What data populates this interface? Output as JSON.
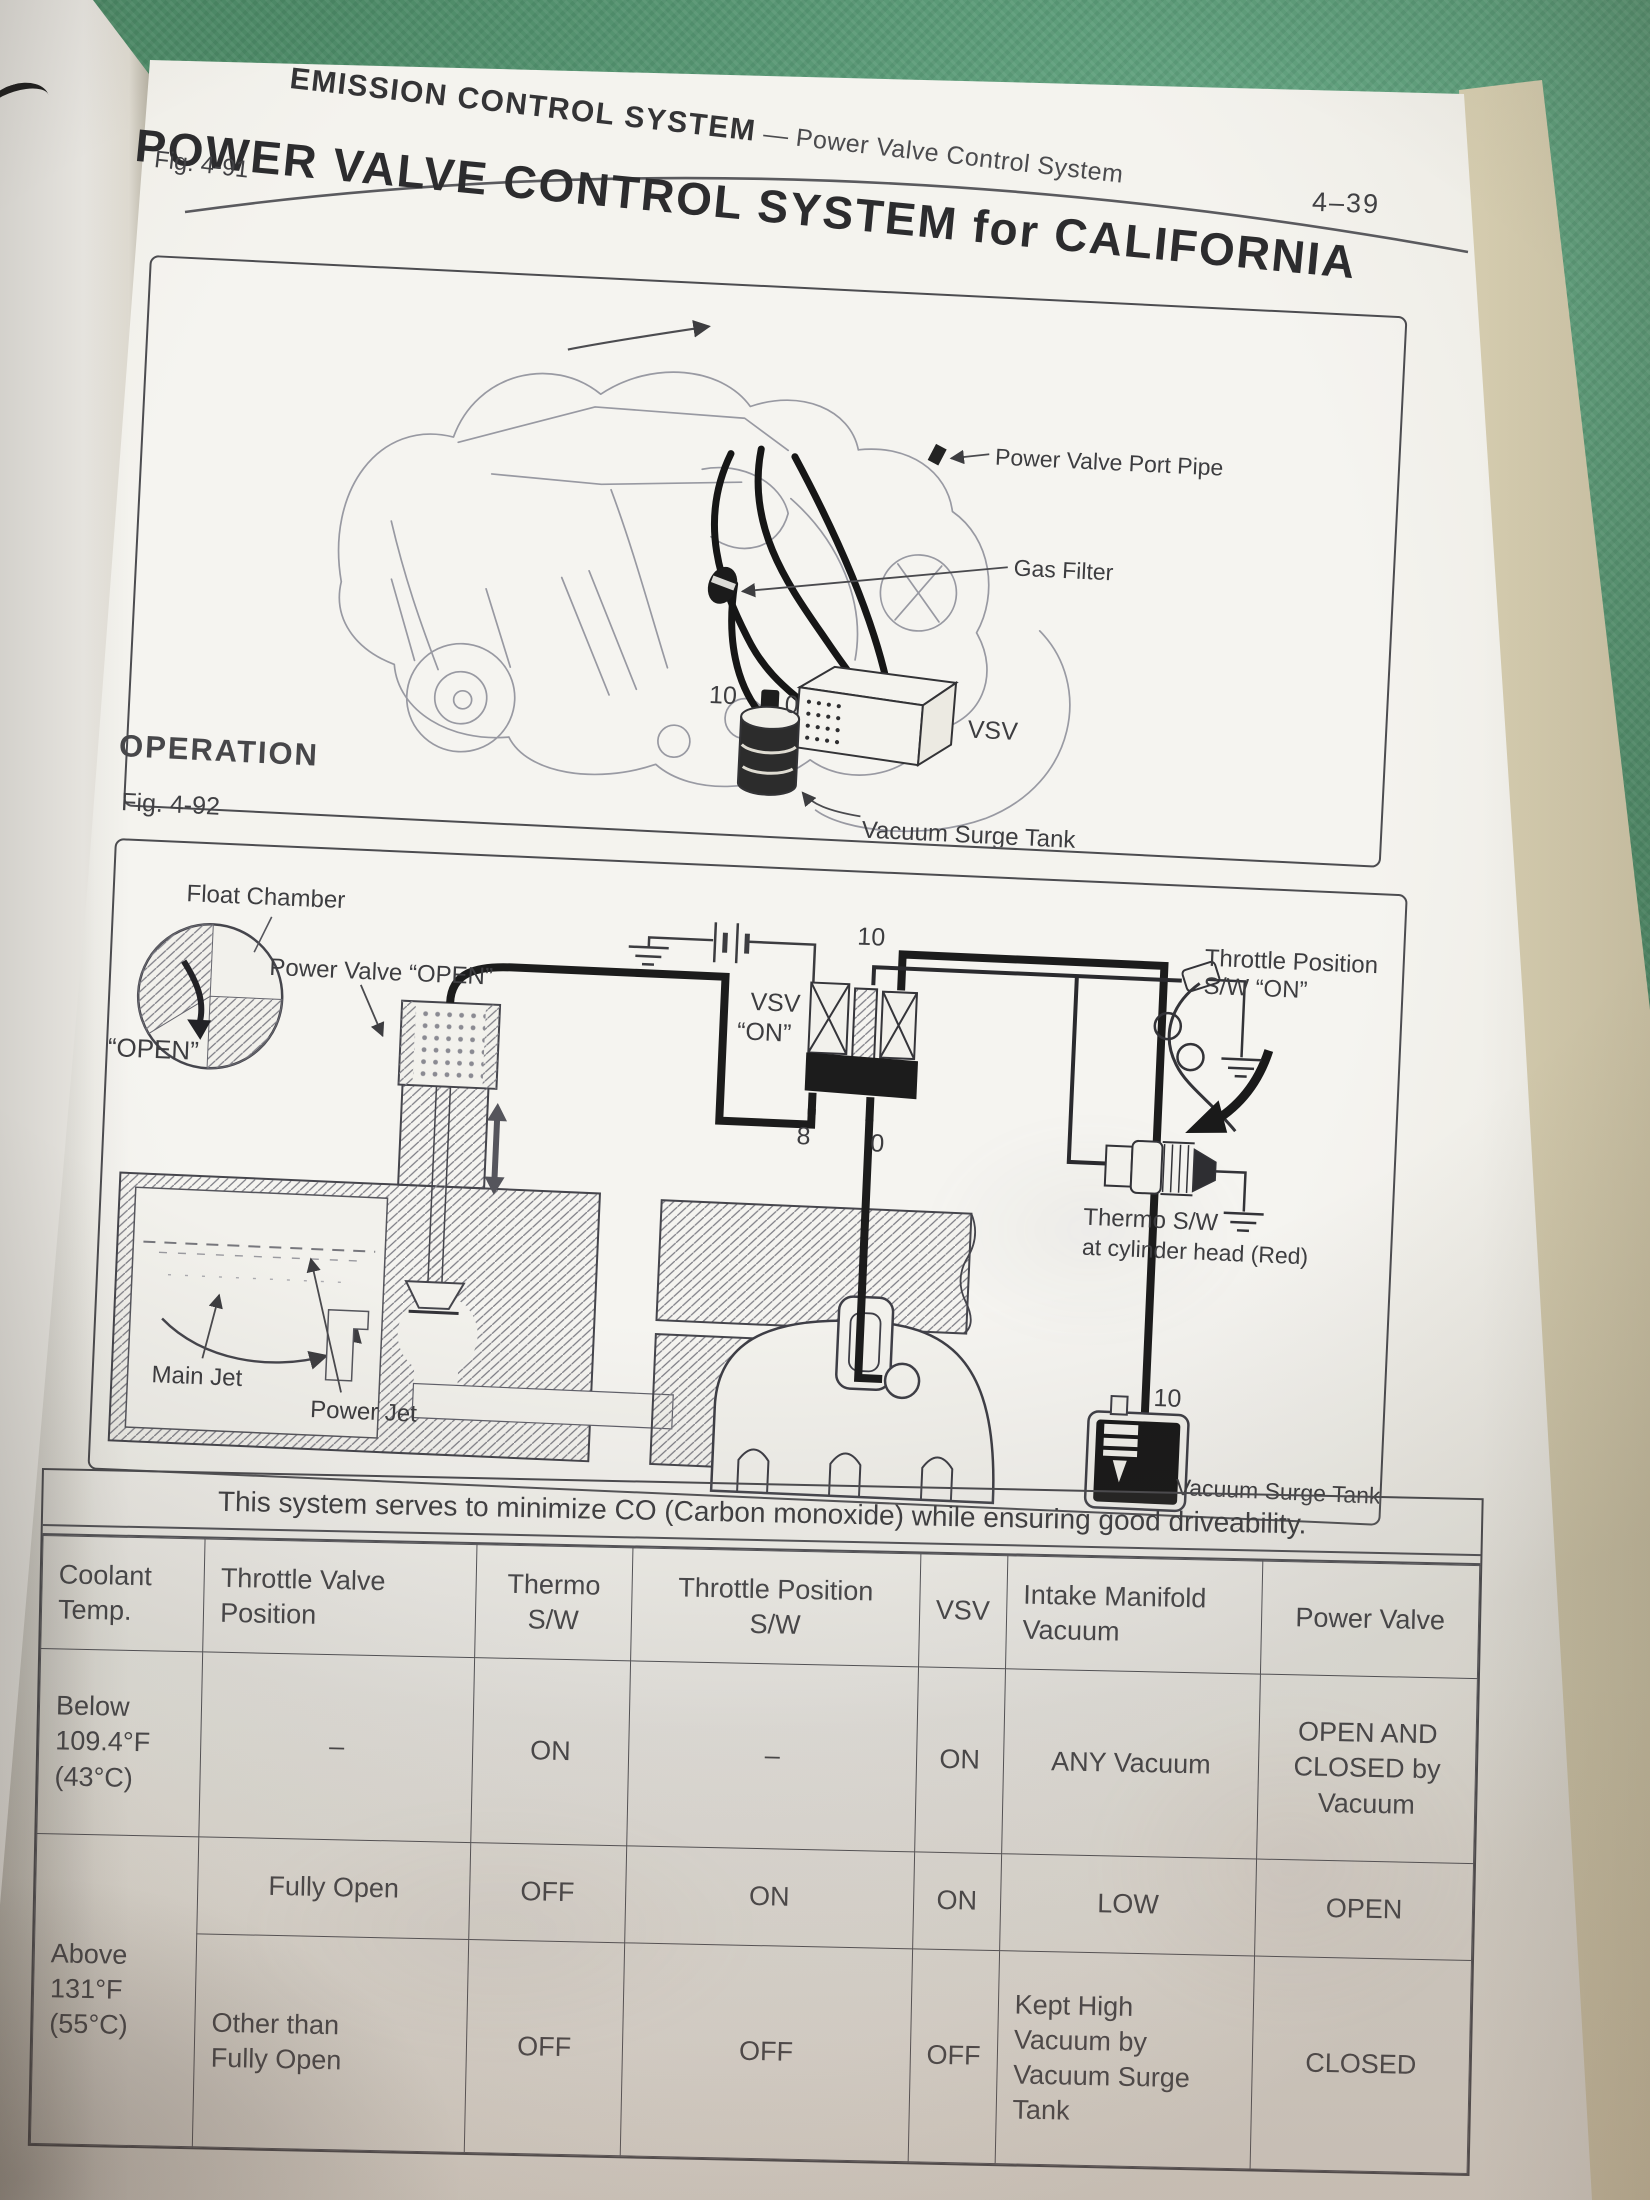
{
  "page": {
    "section_title": "EMISSION CONTROL SYSTEM",
    "section_subtitle": " — Power Valve Control System",
    "page_number": "4–39",
    "title": "POWER VALVE CONTROL SYSTEM for CALIFORNIA",
    "fig1_label": "Fig. 4-91",
    "operation_heading": "OPERATION",
    "fig2_label": "Fig. 4-92"
  },
  "fig1": {
    "power_valve_port_pipe": "Power Valve Port Pipe",
    "gas_filter": "Gas Filter",
    "vsv": "VSV",
    "port_10": "10",
    "port_0": "0",
    "vacuum_surge_tank": "Vacuum Surge Tank"
  },
  "fig2": {
    "float_chamber": "Float Chamber",
    "open": "“OPEN”",
    "power_valve_open": "Power Valve “OPEN”",
    "vsv_line1": "VSV",
    "vsv_line2": "“ON”",
    "port_10_vsv": "10",
    "port_8": "8",
    "port_0": "0",
    "throttle_sw_line1": "Throttle Position",
    "throttle_sw_line2": "S/W “ON”",
    "thermo_line1": "Thermo S/W",
    "thermo_line2": "at cylinder head (Red)",
    "main_jet": "Main Jet",
    "power_jet": "Power Jet",
    "port_10_tank": "10",
    "vacuum_surge_tank": "Vacuum Surge Tank"
  },
  "table": {
    "caption": "This system serves to minimize CO (Carbon monoxide) while ensuring good driveability.",
    "headers": [
      "Coolant\nTemp.",
      "Throttle Valve\nPosition",
      "Thermo\nS/W",
      "Throttle Position\nS/W",
      "VSV",
      "Intake Manifold\nVacuum",
      "Power Valve"
    ],
    "row1": [
      "Below\n109.4°F\n(43°C)",
      "–",
      "ON",
      "–",
      "ON",
      "ANY Vacuum",
      "OPEN AND\nCLOSED by\nVacuum"
    ],
    "row23_temp": "Above\n131°F\n(55°C)",
    "row2": [
      "Fully Open",
      "OFF",
      "ON",
      "ON",
      "LOW",
      "OPEN"
    ],
    "row3": [
      "Other than\nFully Open",
      "OFF",
      "OFF",
      "OFF",
      "Kept High\nVacuum by\nVacuum Surge\nTank",
      "CLOSED"
    ]
  }
}
